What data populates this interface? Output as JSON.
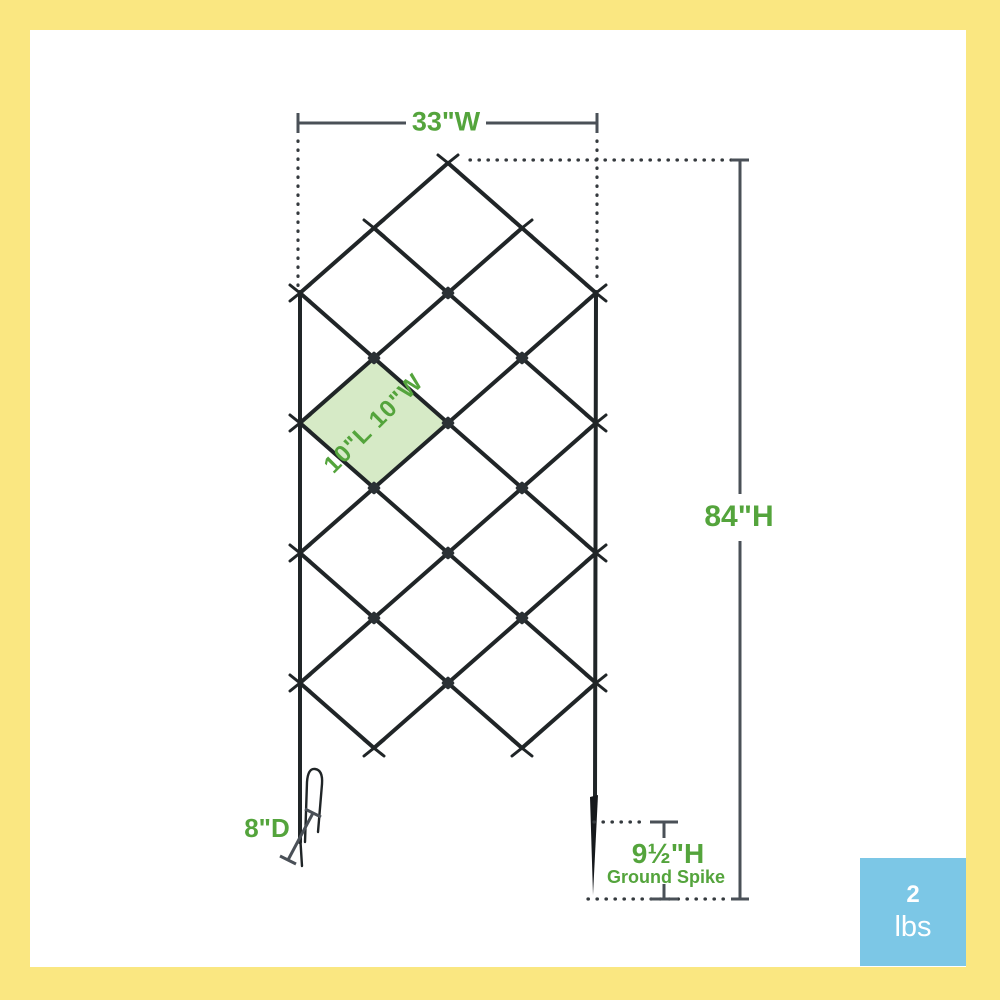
{
  "diagram": {
    "dimensions": {
      "width": "33\"W",
      "height": "84\"H",
      "cell": "10\"L 10\"W",
      "depth": "8\"D",
      "spike_height": "9½\"H",
      "spike_caption": "Ground Spike"
    }
  },
  "weight_badge": {
    "value": "2",
    "unit": "lbs"
  },
  "colors": {
    "frame-yellow": "#FAE781",
    "badge-blue": "#7CC7E6",
    "accent-green": "#54A43C",
    "cell-green": "#D6EAC6",
    "dim-gray": "#4A5057",
    "trellis-dark": "#202527"
  }
}
